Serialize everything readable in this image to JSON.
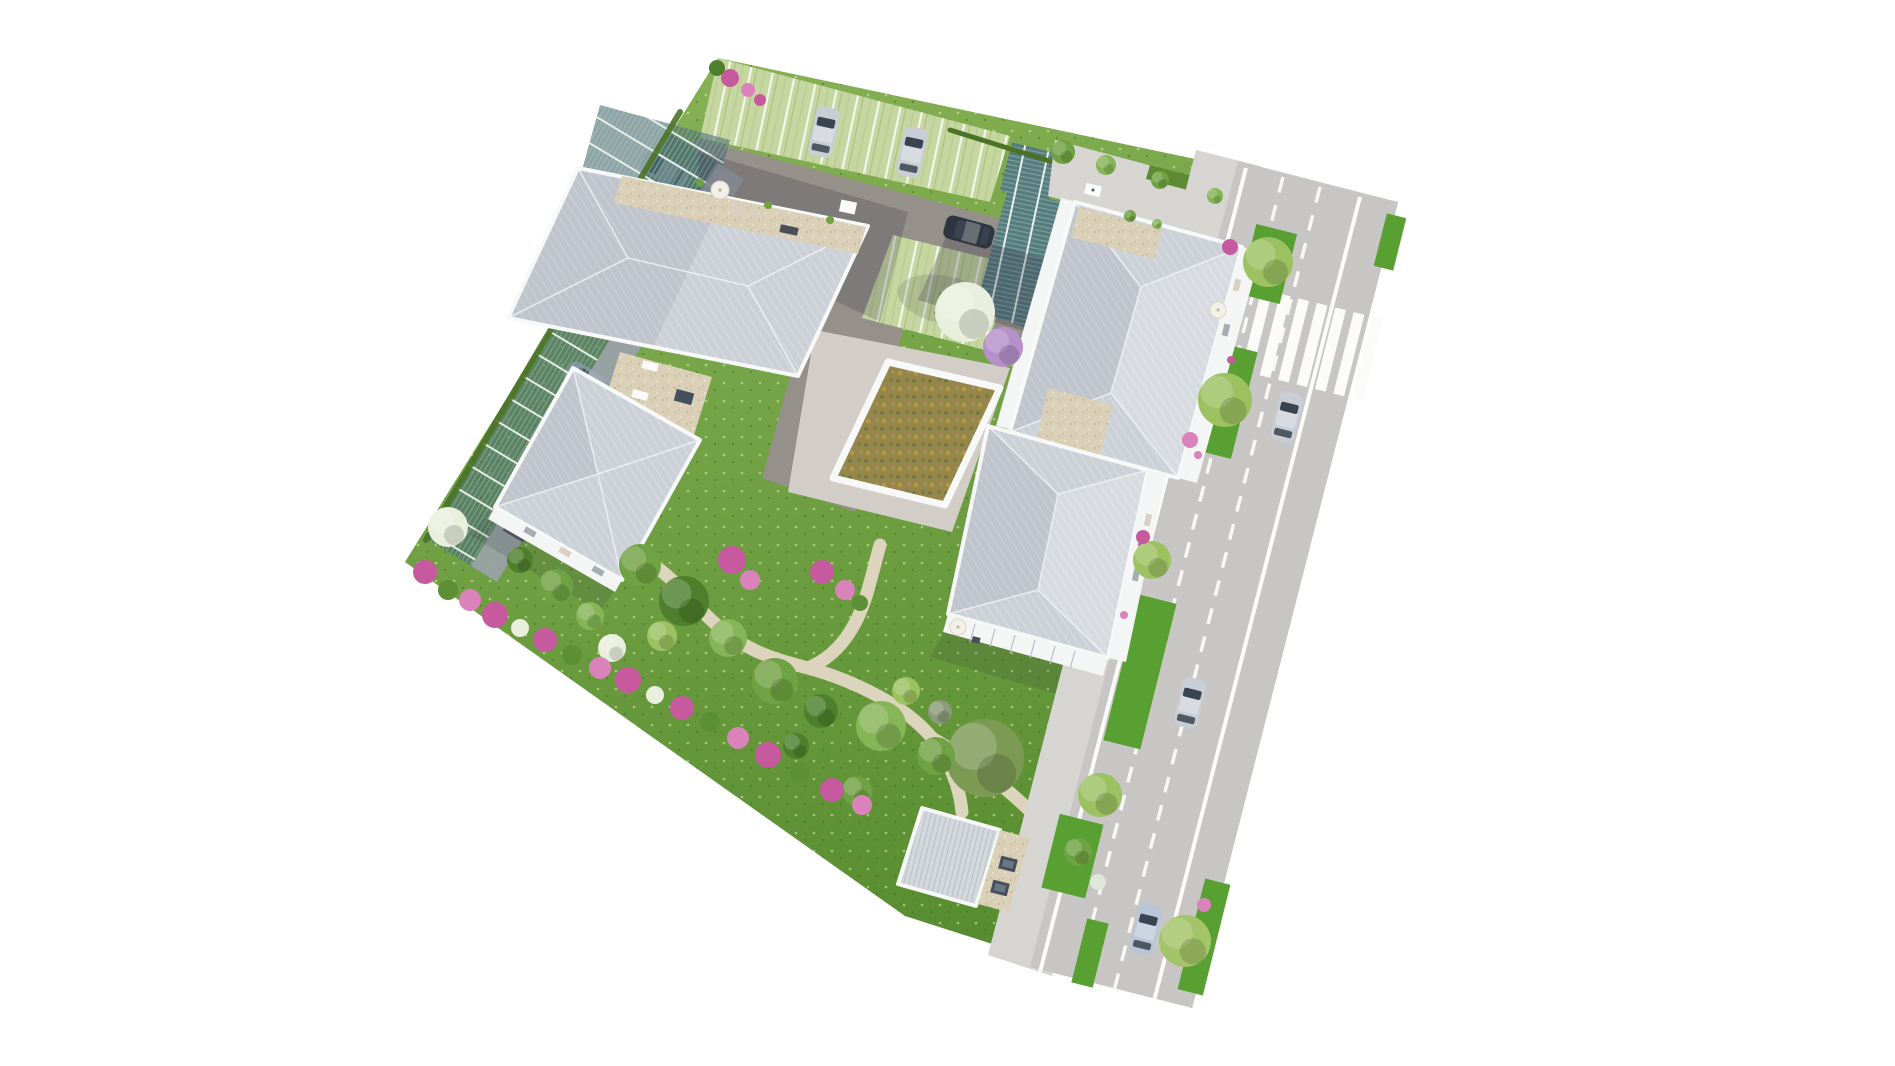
{
  "meta": {
    "description": "Photorealistic top-down 3D architectural rendering (plan de masse) of a residential complex on a white background, rotated roughly 12-30 degrees. No text, labels, buttons or UI controls are visible anywhere in the image.",
    "image_type": "aerial 3D site-plan render",
    "background": "#ffffff",
    "visible_text": "none"
  },
  "palette": {
    "bg": "#ffffff",
    "grassLight": "#8ab457",
    "grassDark": "#578d30",
    "asphalt": "#959089",
    "roof": "#ccd1d8",
    "parapet": "#f7f8f8",
    "concrete": "#d2cdc7",
    "sidewalk": "#d7d5d2",
    "road": "#c8c6c4",
    "roadLine": "#fbfbf9",
    "path": "#dcd4bd",
    "hedge": "#4a7326",
    "shadow": "#2e2c3e",
    "pink": "#c75a9e",
    "pinkLight": "#da83ba",
    "tree1": "#6fa243",
    "tree2": "#4e7f2c",
    "tree3": "#85b556",
    "tree4": "#9cc161",
    "treeOlive": "#7d9a55",
    "flower": "#e9efdd",
    "lilac": "#b491c9",
    "teal": "#567c7e",
    "tealSlat": "#7fa1a1",
    "stall": "#c6d6a0",
    "gravel": "#d9d0b7",
    "greenRoof": "#96864b",
    "carSilver": "#c9ced6",
    "carWhite": "#eff1f3",
    "carDark": "#2f3642",
    "carBlue": "#b9c6d8",
    "glass": "#3a4450"
  },
  "scene": {
    "site": {
      "shape": "rotated irregular quadrilateral",
      "rotation_deg": 12,
      "ground": "lawn with grass-paver parking and gravel paths"
    },
    "buildings": [
      {
        "id": "west-building",
        "roof": "light-gray hipped, two volumes",
        "features": [
          "beige gravel flat-roof link with skylights",
          "rooftop terrace with white parasol and planters",
          "balconies on garden side"
        ]
      },
      {
        "id": "northeast-building",
        "roof": "large light-gray hipped",
        "features": [
          "north rooftop terrace",
          "balcony bands east and west with pink planters",
          "cream parasol on east balcony"
        ]
      },
      {
        "id": "southeast-building",
        "roof": "light-gray hipped",
        "features": [
          "south pergola terrace with white parasol",
          "east balconies with pink planters"
        ]
      },
      {
        "id": "courtyard-building",
        "roof": "extensive green roof, olive-ochre sedum with white parapet"
      },
      {
        "id": "garden-outbuilding",
        "roof": "small light-gray roof, two dark skylights, white gravel edge"
      }
    ],
    "parking": {
      "north_lot": "asphalt aisle with light-green grass-paver stalls and white dividers",
      "carport": "long teal slatted canopy along north-west boundary with cars underneath",
      "cars_parked": 6
    },
    "road": {
      "position": "along east side, clipped by image edge",
      "markings": [
        "solid white edge lines",
        "two dashed white lane lines",
        "zebra crosswalk near top"
      ],
      "verges": "lawn strips with light-green trees and pink shrubs",
      "cars_driving": 3
    },
    "landscape": {
      "lawn": "large gardens south and west",
      "paths": "beige gravel walkways winding through garden",
      "shrub_band": "pink flowering shrubs along south-west boundary",
      "special_trees": [
        "white-flowering tree west garden",
        "large white-flowering tree over parking",
        "lilac tree near courtyard",
        "large olive-green tree south lawn"
      ]
    },
    "vehicles": [
      {
        "id": "parked-car-1",
        "color": "silver",
        "location": "north lot stall"
      },
      {
        "id": "parked-car-2",
        "color": "silver",
        "location": "north lot stall"
      },
      {
        "id": "parked-car-3",
        "color": "dark navy",
        "location": "north aisle"
      },
      {
        "id": "carport-car-1",
        "color": "white",
        "location": "under carport canopy"
      },
      {
        "id": "carport-car-2",
        "color": "white",
        "location": "under carport canopy"
      },
      {
        "id": "carport-car-3",
        "color": "silver",
        "location": "under carport canopy"
      },
      {
        "id": "road-car-1",
        "color": "silver",
        "location": "road below crosswalk"
      },
      {
        "id": "road-car-2",
        "color": "silver",
        "location": "road middle"
      },
      {
        "id": "road-car-3",
        "color": "light blue-silver",
        "location": "road bottom"
      }
    ]
  }
}
